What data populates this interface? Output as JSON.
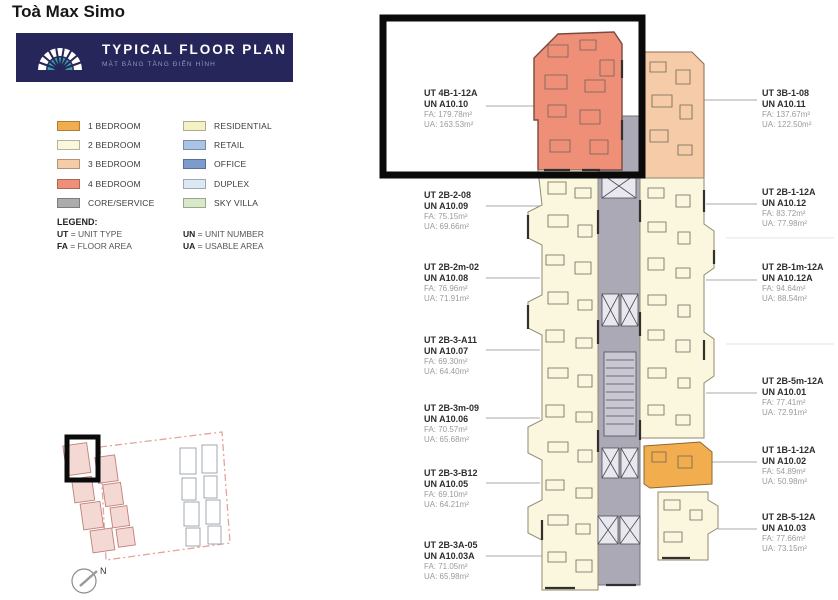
{
  "page": {
    "title": "Toà Max Simo"
  },
  "banner": {
    "title": "TYPICAL FLOOR PLAN",
    "subtitle": "MẶT BẰNG TẦNG ĐIỂN HÌNH",
    "bg_color": "#26265A",
    "logo_icon": "arch-logo",
    "logo_teal": "#3C9FA8"
  },
  "legend": {
    "unit_types": [
      {
        "label": "1 BEDROOM",
        "color": "#F2AE4E"
      },
      {
        "label": "2 BEDROOM",
        "color": "#FBF7DE"
      },
      {
        "label": "3 BEDROOM",
        "color": "#F5CCA7"
      },
      {
        "label": "4 BEDROOM",
        "color": "#EF8F77"
      },
      {
        "label": "CORE/SERVICE",
        "color": "#ACACAC"
      }
    ],
    "zone_types": [
      {
        "label": "RESIDENTIAL",
        "color": "#F5F1C4"
      },
      {
        "label": "RETAIL",
        "color": "#A9C4E4"
      },
      {
        "label": "OFFICE",
        "color": "#7C9CCE"
      },
      {
        "label": "DUPLEX",
        "color": "#DCE9F4"
      },
      {
        "label": "SKY VILLA",
        "color": "#D8E8C8"
      }
    ],
    "abbr_title": "LEGEND:",
    "abbreviations": [
      {
        "code": "UT",
        "meaning": "UNIT TYPE"
      },
      {
        "code": "UN",
        "meaning": "UNIT NUMBER"
      },
      {
        "code": "FA",
        "meaning": "FLOOR AREA"
      },
      {
        "code": "UA",
        "meaning": "USABLE AREA"
      }
    ]
  },
  "units_left": [
    {
      "ut": "UT 4B-1-12A",
      "un": "UN A10.10",
      "fa": "FA: 179.78m²",
      "ua": "UA: 163.53m²"
    },
    {
      "ut": "UT 2B-2-08",
      "un": "UN A10.09",
      "fa": "FA: 75.15m²",
      "ua": "UA: 69.66m²"
    },
    {
      "ut": "UT 2B-2m-02",
      "un": "UN A10.08",
      "fa": "FA: 76.96m²",
      "ua": "UA: 71.91m²"
    },
    {
      "ut": "UT 2B-3-A11",
      "un": "UN A10.07",
      "fa": "FA: 69.30m²",
      "ua": "UA: 64.40m²"
    },
    {
      "ut": "UT 2B-3m-09",
      "un": "UN A10.06",
      "fa": "FA: 70.57m²",
      "ua": "UA: 65.68m²"
    },
    {
      "ut": "UT 2B-3-B12",
      "un": "UN A10.05",
      "fa": "FA: 69.10m²",
      "ua": "UA: 64.21m²"
    },
    {
      "ut": "UT 2B-3A-05",
      "un": "UN A10.03A",
      "fa": "FA: 71.05m²",
      "ua": "UA: 65.98m²"
    }
  ],
  "units_right": [
    {
      "ut": "UT 3B-1-08",
      "un": "UN A10.11",
      "fa": "FA: 137.67m²",
      "ua": "UA: 122.50m²"
    },
    {
      "ut": "UT 2B-1-12A",
      "un": "UN A10.12",
      "fa": "FA: 83.72m²",
      "ua": "UA: 77.98m²"
    },
    {
      "ut": "UT 2B-1m-12A",
      "un": "UN A10.12A",
      "fa": "FA: 94.64m²",
      "ua": "UA: 88.54m²"
    },
    {
      "ut": "UT 2B-5m-12A",
      "un": "UN A10.01",
      "fa": "FA: 77.41m²",
      "ua": "UA: 72.91m²"
    },
    {
      "ut": "UT 1B-1-12A",
      "un": "UN A10.02",
      "fa": "FA: 54.89m²",
      "ua": "UA: 50.98m²"
    },
    {
      "ut": "UT 2B-5-12A",
      "un": "UN A10.03",
      "fa": "FA: 77.66m²",
      "ua": "UA: 73.15m²"
    }
  ],
  "minimap": {
    "north_label": "N"
  },
  "plan_colors": {
    "one_bed": "#F2AE4E",
    "two_bed": "#FBF7DE",
    "three_bed": "#F5CCA7",
    "four_bed": "#EF8F77",
    "core": "#ABA9B6"
  }
}
